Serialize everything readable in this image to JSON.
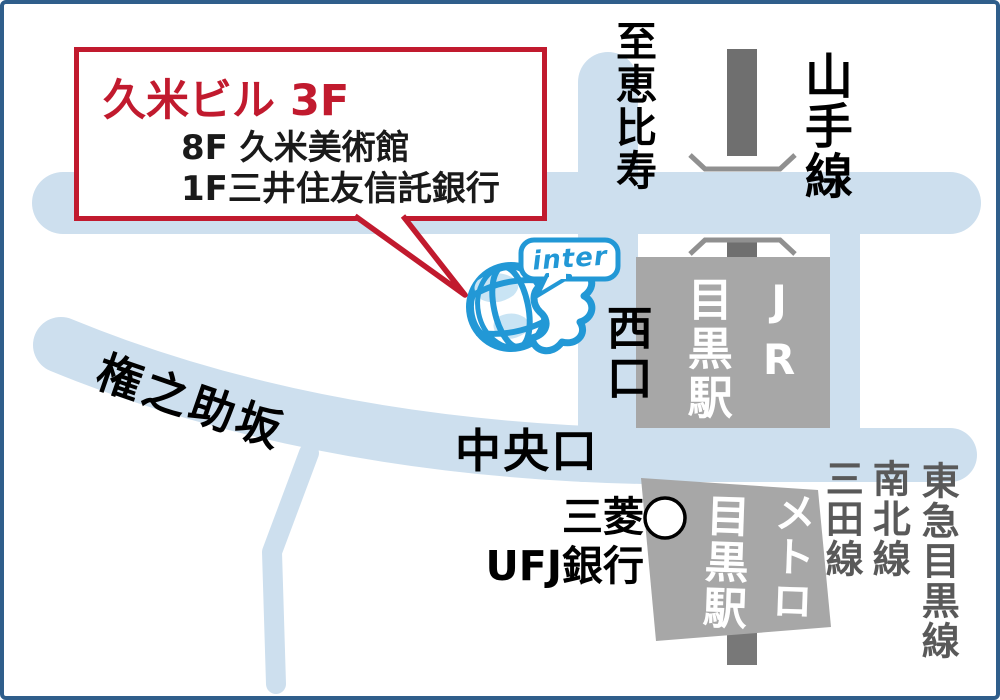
{
  "callout": {
    "title": "久米ビル 3F",
    "line1": "8F 久米美術館",
    "line2": "1F三井住友信託銀行"
  },
  "logo": {
    "text": "inter"
  },
  "labels": {
    "to_ebisu": "至恵比寿",
    "yamanote_line": "山手線",
    "west_exit": "西口",
    "central_exit": "中央口",
    "gonnosuke_zaka": "権之助坂",
    "bank_line1": "三菱",
    "bank_line2": "UFJ銀行"
  },
  "stations": {
    "jr": {
      "company": "JR",
      "name": "目黒駅"
    },
    "metro": {
      "company": "メトロ",
      "name": "目黒駅"
    }
  },
  "rail_lines_right": [
    "三田線",
    "南北線",
    "東急目黒線"
  ],
  "colors": {
    "road": "#cddfee",
    "building": "#a7a7a7",
    "rail": "#6f6f6f",
    "rail_bracket": "#909090",
    "accent_red": "#c11a2e",
    "logo_blue": "#2298d6",
    "frame_blue": "#2f5e8b",
    "line_label_gray": "#595959"
  }
}
